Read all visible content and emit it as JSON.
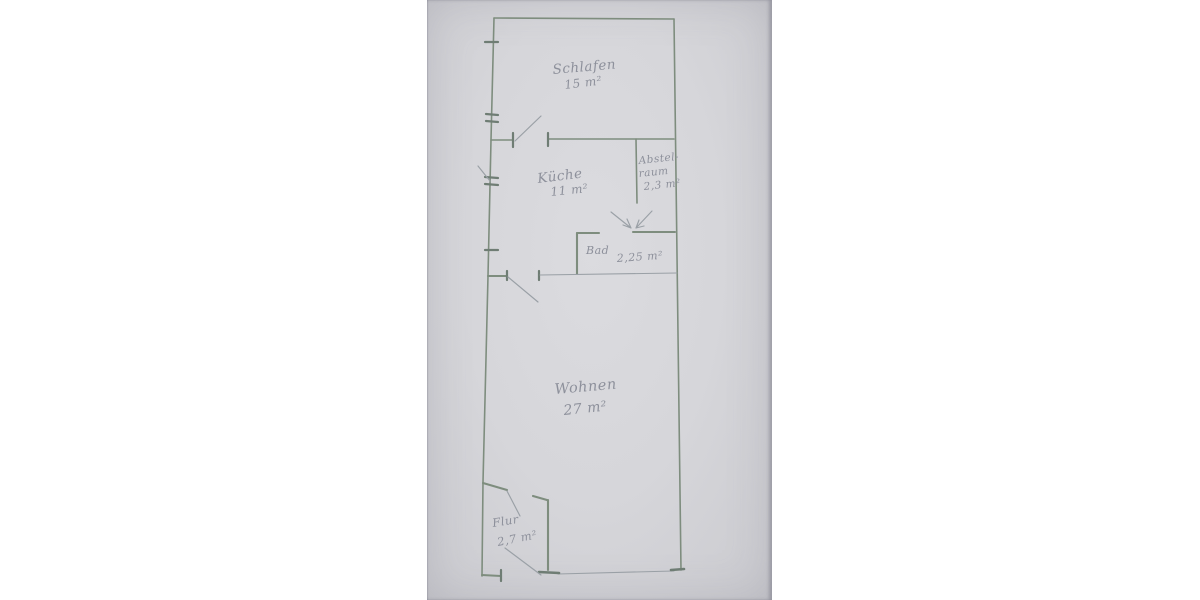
{
  "labels": {
    "schlafen": {
      "name": "Schlafen",
      "area": "15 m²"
    },
    "kueche": {
      "name": "Küche",
      "area": "11 m²"
    },
    "abstellraum": {
      "name_line1": "Abstel-",
      "name_line2": "raum",
      "area": "2,3 m²"
    },
    "bad": {
      "name": "Bad",
      "area": "2,25 m²"
    },
    "wohnen": {
      "name": "Wohnen",
      "area": "27 m²"
    },
    "flur": {
      "name": "Flur",
      "area": "2,7 m²"
    }
  },
  "colors": {
    "paper": "#d7d7db",
    "wall": "#7e8d7e",
    "tick": "#6f7d74",
    "line": "#9aa0a6",
    "ink": "#8d909b",
    "background": "#ffffff"
  }
}
